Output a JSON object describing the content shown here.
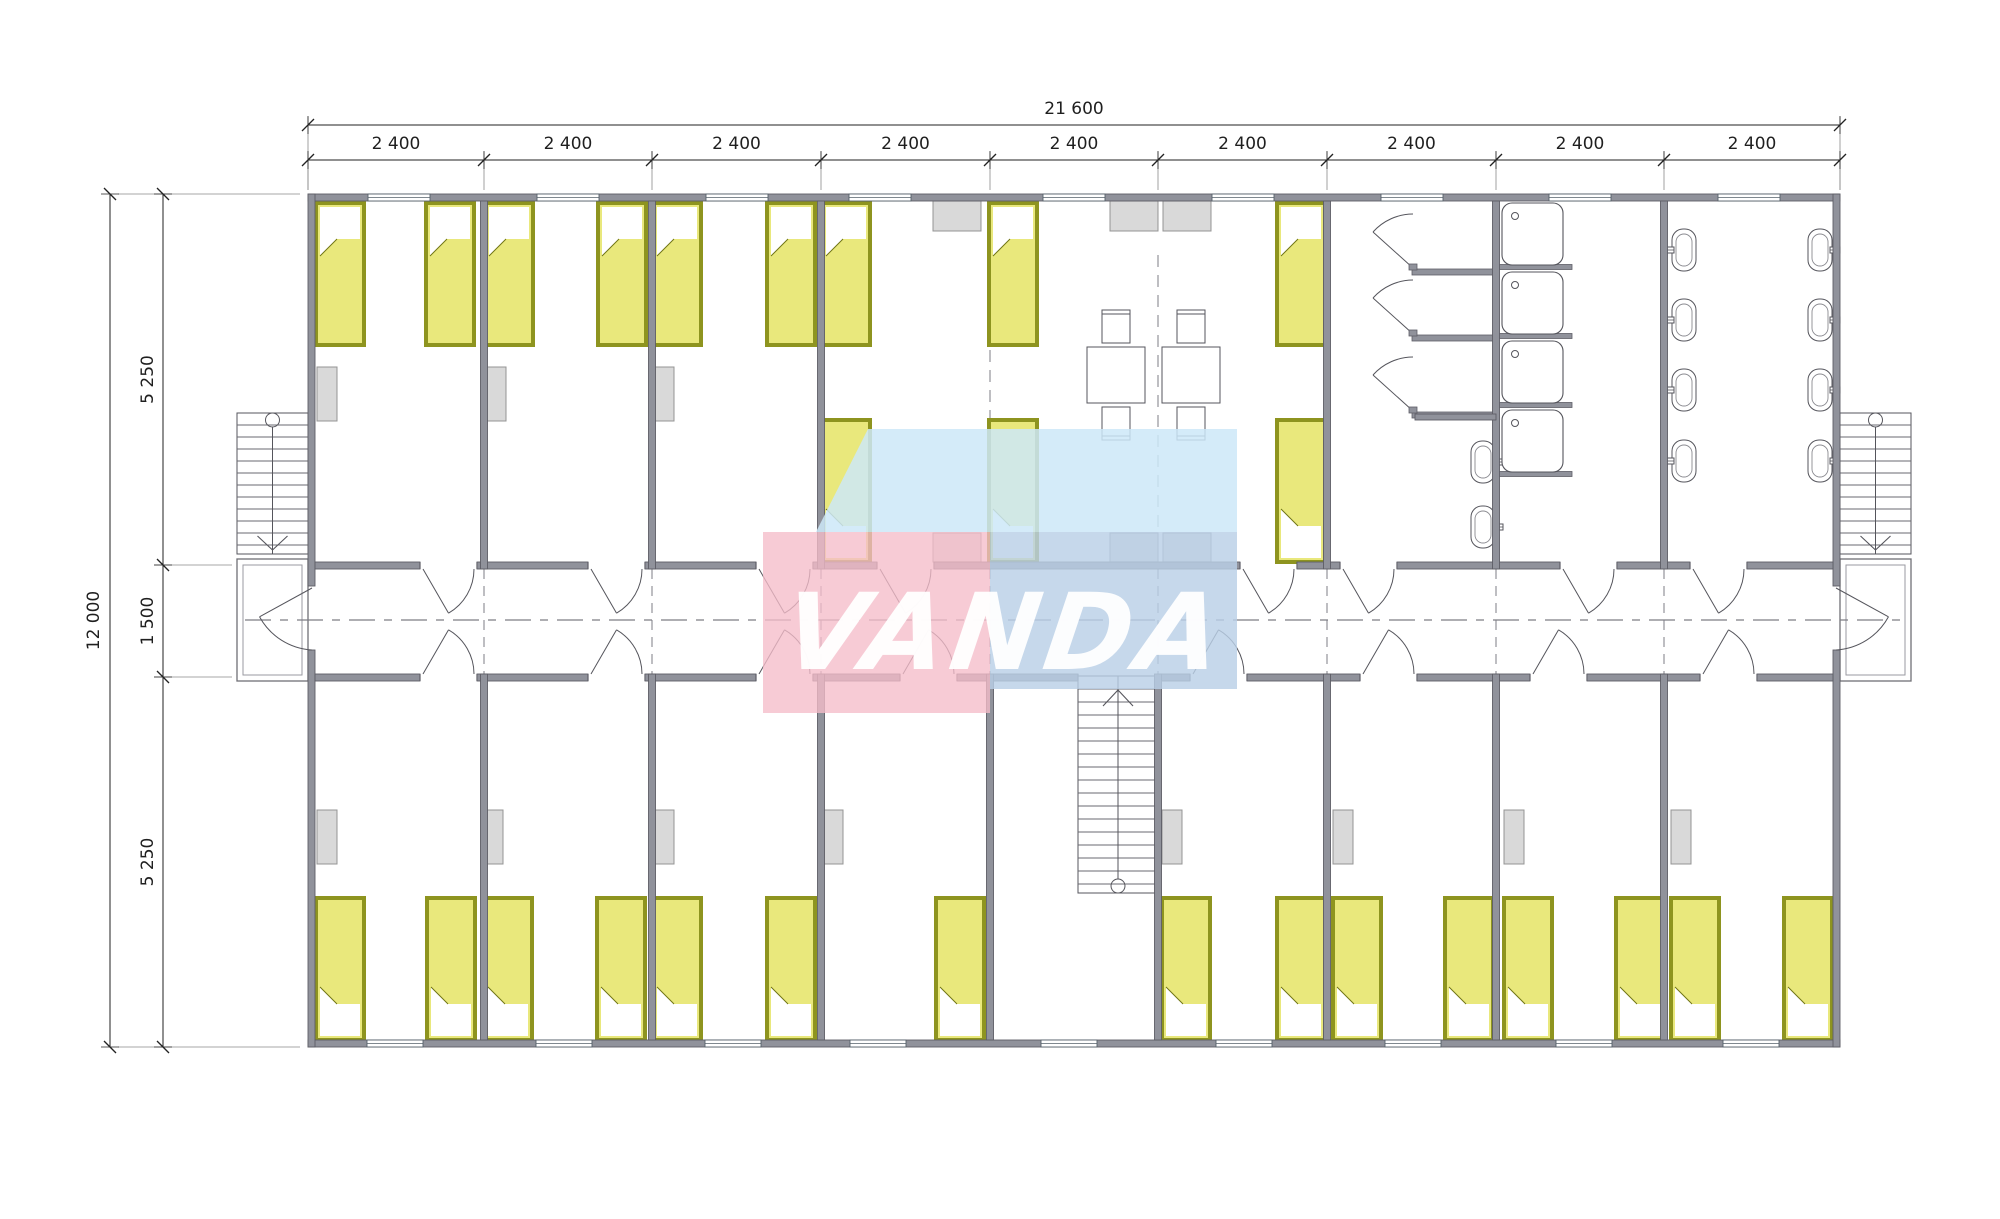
{
  "watermark": {
    "text": "VANDA",
    "colors": {
      "pink": "#f5bcc9",
      "light_blue": "#cde8f8",
      "steel_blue": "#b9d0e6",
      "text": "#ffffff"
    }
  },
  "dimensions": {
    "horizontal": {
      "total": "21 600",
      "modules": [
        "2 400",
        "2 400",
        "2 400",
        "2 400",
        "2 400",
        "2 400",
        "2 400",
        "2 400",
        "2 400"
      ]
    },
    "vertical": {
      "total": "12 000",
      "segments": [
        "5 250",
        "1 500",
        "5 250"
      ]
    }
  },
  "colors": {
    "bg": "#ffffff",
    "wall": "#90929b",
    "wall_edge": "#5e5e66",
    "line": "#4c4c52",
    "thin": "#6a6a70",
    "dash": "#7d7d85",
    "bed_fill": "#e9e87c",
    "bed_border": "#8e941f",
    "bed_border_dark": "#6f7414",
    "furniture_fill": "#d9d9d9",
    "furniture_edge": "#949494",
    "dim": "#222222",
    "ext": "#8a8a8a"
  },
  "inventory": {
    "drawing_type": "modular dormitory floor plan",
    "rooms": [
      "bedroom-1",
      "bedroom-2",
      "bedroom-3",
      "common-room",
      "shower-room",
      "shower-tray-room",
      "washroom",
      "corridor",
      "stair-hall",
      "bedroom-4",
      "bedroom-5",
      "bedroom-6",
      "bedroom-7",
      "bedroom-8",
      "bedroom-9"
    ],
    "beds_top_row": 9,
    "beds_middle_row": 3,
    "beds_bottom_row": 15,
    "beds_total": 27,
    "tables": 2,
    "chairs": 4,
    "wardrobes": 11,
    "vent_units": 6,
    "shower_cubicles": 3,
    "shower_trays": 4,
    "wash_basins": 10,
    "exterior_stairs": 2,
    "interior_stairs": 1,
    "porches": 2
  },
  "geometry": {
    "canvas": {
      "w": 2000,
      "h": 1219
    },
    "building": {
      "x1": 308,
      "y1": 194,
      "x2": 1840,
      "y2": 1047,
      "wall": 7
    },
    "interior": {
      "left": 315,
      "right": 1833
    },
    "corridor": {
      "top": 562,
      "bottom": 681,
      "center": 620
    },
    "bands": {
      "topRoomY1": 201,
      "topRoomY2": 562,
      "botRoomY1": 674,
      "botRoomY2": 1040
    },
    "hTicks": [
      308,
      484,
      652,
      821,
      990,
      1158,
      1327,
      1496,
      1664,
      1840
    ],
    "vTicks": [
      194,
      565,
      677,
      1047
    ],
    "dimLines": {
      "topTotalY": 125,
      "topModY": 160,
      "leftTotalX": 110,
      "leftSegX": 163,
      "labelTopTotalY": 114,
      "labelTopModY": 149
    },
    "topBandWalls": [
      484,
      652,
      821,
      1327,
      1496,
      1664
    ],
    "bottomBandWalls": [
      484,
      652,
      821,
      990,
      1158,
      1327,
      1496,
      1664
    ],
    "bed": {
      "w": 48,
      "h": 142
    },
    "beds": {
      "top": {
        "y": 203,
        "pillow": "top",
        "x": [
          316,
          426,
          485,
          598,
          653,
          767,
          822,
          989,
          1277
        ]
      },
      "mid": {
        "y": 420,
        "pillow": "bottom",
        "x": [
          822,
          989,
          1277
        ]
      },
      "bottom": {
        "y": 898,
        "pillow": "bottom",
        "x": [
          316,
          427,
          484,
          597,
          653,
          767,
          936,
          1162,
          1277,
          1333,
          1445,
          1504,
          1616,
          1671,
          1784
        ]
      }
    },
    "wardrobes": {
      "w": 20,
      "h": 54,
      "top": {
        "y": 367,
        "x": [
          317,
          486,
          654
        ]
      },
      "bottom": {
        "y": 810,
        "x": [
          317,
          483,
          654,
          823,
          1162,
          1333,
          1504,
          1671
        ]
      }
    },
    "vents": {
      "w": 48,
      "top": {
        "y": 201,
        "h": 30,
        "x": [
          933,
          1110,
          1163
        ]
      },
      "corridorSide": {
        "y": 533,
        "h": 29,
        "x": [
          933,
          1110,
          1163
        ]
      }
    },
    "windows": {
      "top": {
        "w": 62,
        "centers": [
          399,
          568,
          737,
          880,
          1074,
          1243,
          1412,
          1580,
          1749
        ]
      },
      "bottom": {
        "w": 56,
        "centers": [
          395,
          564,
          733,
          878,
          1069,
          1244,
          1413,
          1584,
          1751
        ]
      }
    },
    "doorsTop": [
      [
        420,
        477
      ],
      [
        588,
        645
      ],
      [
        756,
        813
      ],
      [
        877,
        934
      ],
      [
        1240,
        1297
      ],
      [
        1340,
        1397
      ],
      [
        1560,
        1617
      ],
      [
        1690,
        1747
      ]
    ],
    "doorsBottom": [
      [
        420,
        477
      ],
      [
        588,
        645
      ],
      [
        756,
        813
      ],
      [
        900,
        957
      ],
      [
        1190,
        1247
      ],
      [
        1360,
        1417
      ],
      [
        1530,
        1587
      ],
      [
        1700,
        1757
      ]
    ],
    "stairOpening": [
      1078,
      1158
    ],
    "entranceDoorY": [
      586,
      650
    ],
    "tables": {
      "x": [
        1087,
        1162
      ],
      "y": 347,
      "w": 58,
      "h": 56,
      "chair": {
        "w": 28,
        "h": 33
      }
    },
    "showerRoom": {
      "doorLineX": 1413,
      "partitions": [
        272,
        338,
        415
      ],
      "partX1": 1412,
      "partX2": 1496,
      "basins": [
        [
          1483,
          462
        ],
        [
          1483,
          527
        ]
      ]
    },
    "trayRoom": {
      "x": 1502,
      "w": 61,
      "h": 62,
      "ys": [
        203,
        272,
        341,
        410
      ],
      "partYs": [
        267,
        336,
        405,
        474
      ],
      "partX1": 1496,
      "partX2": 1572
    },
    "washroom": {
      "leftX": 1684,
      "rightX": 1820,
      "ys": [
        250,
        320,
        390,
        461
      ]
    },
    "extStairs": {
      "y1": 413,
      "y2": 554,
      "left": [
        237,
        308
      ],
      "right": [
        1840,
        1911
      ]
    },
    "porch": {
      "y1": 559,
      "y2": 681
    },
    "centralStair": {
      "x1": 1078,
      "x2": 1158,
      "y1": 676,
      "y2": 893
    },
    "dashJointsX": [
      484,
      652,
      821,
      990,
      1158,
      1327,
      1496,
      1664
    ],
    "commonRoomDashes": [
      {
        "x": 990,
        "y1": 350,
        "y2": 560
      },
      {
        "x": 1158,
        "y1": 255,
        "y2": 560
      }
    ]
  }
}
